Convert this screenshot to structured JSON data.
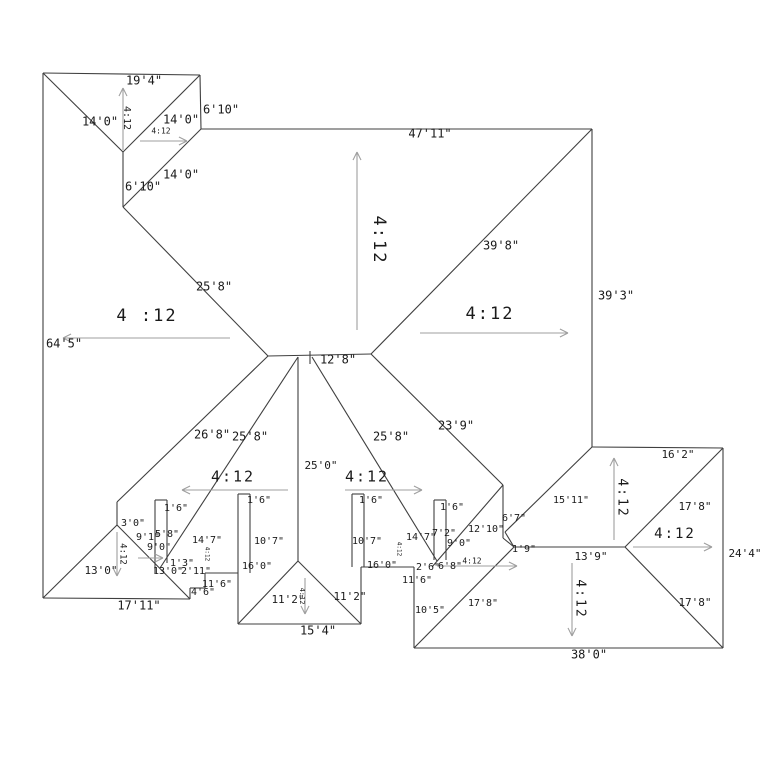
{
  "diagram": {
    "type": "roof-plan",
    "background": "#ffffff",
    "line_color": "#3f3f3f",
    "arrow_color": "#9f9f9f",
    "text_color": "#1a1a1a",
    "default_pitch": "4:12"
  },
  "lines": [
    {
      "x1": 43,
      "y1": 73,
      "x2": 200,
      "y2": 75
    },
    {
      "x1": 200,
      "y1": 75,
      "x2": 201,
      "y2": 129
    },
    {
      "x1": 201,
      "y1": 129,
      "x2": 592,
      "y2": 129
    },
    {
      "x1": 592,
      "y1": 129,
      "x2": 592,
      "y2": 447
    },
    {
      "x1": 592,
      "y1": 447,
      "x2": 723,
      "y2": 448
    },
    {
      "x1": 723,
      "y1": 448,
      "x2": 723,
      "y2": 648
    },
    {
      "x1": 723,
      "y1": 648,
      "x2": 414,
      "y2": 648
    },
    {
      "x1": 414,
      "y1": 648,
      "x2": 414,
      "y2": 567
    },
    {
      "x1": 414,
      "y1": 567,
      "x2": 361,
      "y2": 567
    },
    {
      "x1": 361,
      "y1": 567,
      "x2": 361,
      "y2": 624
    },
    {
      "x1": 361,
      "y1": 624,
      "x2": 238,
      "y2": 624
    },
    {
      "x1": 238,
      "y1": 624,
      "x2": 238,
      "y2": 573
    },
    {
      "x1": 238,
      "y1": 573,
      "x2": 205,
      "y2": 573
    },
    {
      "x1": 205,
      "y1": 573,
      "x2": 205,
      "y2": 588
    },
    {
      "x1": 205,
      "y1": 588,
      "x2": 190,
      "y2": 588
    },
    {
      "x1": 190,
      "y1": 588,
      "x2": 190,
      "y2": 599
    },
    {
      "x1": 190,
      "y1": 599,
      "x2": 43,
      "y2": 598
    },
    {
      "x1": 43,
      "y1": 598,
      "x2": 43,
      "y2": 73
    },
    {
      "x1": 43,
      "y1": 73,
      "x2": 123,
      "y2": 152
    },
    {
      "x1": 200,
      "y1": 75,
      "x2": 123,
      "y2": 152
    },
    {
      "x1": 123,
      "y1": 152,
      "x2": 123,
      "y2": 207
    },
    {
      "x1": 123,
      "y1": 207,
      "x2": 201,
      "y2": 129
    },
    {
      "x1": 123,
      "y1": 207,
      "x2": 268,
      "y2": 356
    },
    {
      "x1": 268,
      "y1": 356,
      "x2": 371,
      "y2": 354
    },
    {
      "x1": 592,
      "y1": 129,
      "x2": 371,
      "y2": 354
    },
    {
      "x1": 310,
      "y1": 351,
      "x2": 310,
      "y2": 364
    },
    {
      "x1": 268,
      "y1": 356,
      "x2": 117,
      "y2": 502
    },
    {
      "x1": 117,
      "y1": 502,
      "x2": 117,
      "y2": 525
    },
    {
      "x1": 117,
      "y1": 525,
      "x2": 43,
      "y2": 598
    },
    {
      "x1": 117,
      "y1": 525,
      "x2": 190,
      "y2": 599
    },
    {
      "x1": 298,
      "y1": 357,
      "x2": 160,
      "y2": 568
    },
    {
      "x1": 298,
      "y1": 357,
      "x2": 298,
      "y2": 561
    },
    {
      "x1": 312,
      "y1": 357,
      "x2": 437,
      "y2": 561
    },
    {
      "x1": 371,
      "y1": 354,
      "x2": 503,
      "y2": 485
    },
    {
      "x1": 298,
      "y1": 561,
      "x2": 238,
      "y2": 624
    },
    {
      "x1": 298,
      "y1": 561,
      "x2": 361,
      "y2": 624
    },
    {
      "x1": 503,
      "y1": 485,
      "x2": 503,
      "y2": 538
    },
    {
      "x1": 503,
      "y1": 538,
      "x2": 514,
      "y2": 547
    },
    {
      "x1": 503,
      "y1": 485,
      "x2": 432,
      "y2": 567
    },
    {
      "x1": 592,
      "y1": 447,
      "x2": 505,
      "y2": 532
    },
    {
      "x1": 505,
      "y1": 532,
      "x2": 514,
      "y2": 547
    },
    {
      "x1": 514,
      "y1": 547,
      "x2": 625,
      "y2": 547
    },
    {
      "x1": 723,
      "y1": 448,
      "x2": 625,
      "y2": 547
    },
    {
      "x1": 723,
      "y1": 648,
      "x2": 625,
      "y2": 547
    },
    {
      "x1": 414,
      "y1": 648,
      "x2": 514,
      "y2": 547
    },
    {
      "x1": 155,
      "y1": 500,
      "x2": 167,
      "y2": 500
    },
    {
      "x1": 155,
      "y1": 500,
      "x2": 155,
      "y2": 573
    },
    {
      "x1": 167,
      "y1": 500,
      "x2": 167,
      "y2": 563
    },
    {
      "x1": 238,
      "y1": 494,
      "x2": 250,
      "y2": 494
    },
    {
      "x1": 238,
      "y1": 494,
      "x2": 238,
      "y2": 573
    },
    {
      "x1": 250,
      "y1": 494,
      "x2": 250,
      "y2": 573
    },
    {
      "x1": 352,
      "y1": 494,
      "x2": 364,
      "y2": 494
    },
    {
      "x1": 352,
      "y1": 494,
      "x2": 352,
      "y2": 567
    },
    {
      "x1": 364,
      "y1": 494,
      "x2": 364,
      "y2": 567
    },
    {
      "x1": 434,
      "y1": 500,
      "x2": 446,
      "y2": 500
    },
    {
      "x1": 434,
      "y1": 500,
      "x2": 434,
      "y2": 560
    },
    {
      "x1": 446,
      "y1": 500,
      "x2": 446,
      "y2": 560
    }
  ],
  "arrows": [
    {
      "x1": 123,
      "y1": 150,
      "x2": 123,
      "y2": 88
    },
    {
      "x1": 140,
      "y1": 141,
      "x2": 187,
      "y2": 141
    },
    {
      "x1": 357,
      "y1": 330,
      "x2": 357,
      "y2": 152
    },
    {
      "x1": 420,
      "y1": 333,
      "x2": 568,
      "y2": 333
    },
    {
      "x1": 230,
      "y1": 338,
      "x2": 63,
      "y2": 338
    },
    {
      "x1": 288,
      "y1": 490,
      "x2": 182,
      "y2": 490
    },
    {
      "x1": 345,
      "y1": 490,
      "x2": 422,
      "y2": 490
    },
    {
      "x1": 138,
      "y1": 558,
      "x2": 163,
      "y2": 558
    },
    {
      "x1": 437,
      "y1": 566,
      "x2": 517,
      "y2": 566
    },
    {
      "x1": 117,
      "y1": 532,
      "x2": 117,
      "y2": 576
    },
    {
      "x1": 305,
      "y1": 578,
      "x2": 305,
      "y2": 614
    },
    {
      "x1": 614,
      "y1": 540,
      "x2": 614,
      "y2": 458
    },
    {
      "x1": 633,
      "y1": 547,
      "x2": 712,
      "y2": 547
    },
    {
      "x1": 572,
      "y1": 563,
      "x2": 572,
      "y2": 636
    }
  ],
  "labels": [
    {
      "t": "19'4\"",
      "x": 144,
      "y": 81,
      "s": 12
    },
    {
      "t": "14'0\"",
      "x": 100,
      "y": 122,
      "s": 12
    },
    {
      "t": "4:12",
      "x": 127,
      "y": 118,
      "s": 10,
      "r": 90
    },
    {
      "t": "14'0\"",
      "x": 181,
      "y": 120,
      "s": 12
    },
    {
      "t": "6'10\"",
      "x": 221,
      "y": 110,
      "s": 12
    },
    {
      "t": "4:12",
      "x": 161,
      "y": 131,
      "s": 8,
      "c": "gray"
    },
    {
      "t": "6'10\"",
      "x": 143,
      "y": 187,
      "s": 12
    },
    {
      "t": "14'0\"",
      "x": 181,
      "y": 175,
      "s": 12
    },
    {
      "t": "47'11\"",
      "x": 430,
      "y": 134,
      "s": 12
    },
    {
      "t": "4:12",
      "x": 379,
      "y": 240,
      "s": 17,
      "r": 90,
      "p": 1
    },
    {
      "t": "39'8\"",
      "x": 501,
      "y": 246,
      "s": 12
    },
    {
      "t": "39'3\"",
      "x": 616,
      "y": 296,
      "s": 12
    },
    {
      "t": "4:12",
      "x": 490,
      "y": 314,
      "s": 17,
      "p": 1
    },
    {
      "t": "4 :12",
      "x": 147,
      "y": 316,
      "s": 17,
      "p": 1
    },
    {
      "t": "64'5\"",
      "x": 64,
      "y": 344,
      "s": 12
    },
    {
      "t": "25'8\"",
      "x": 214,
      "y": 287,
      "s": 12
    },
    {
      "t": "12'8\"",
      "x": 338,
      "y": 360,
      "s": 12
    },
    {
      "t": "26'8\"",
      "x": 212,
      "y": 435,
      "s": 12
    },
    {
      "t": "25'8\"",
      "x": 250,
      "y": 437,
      "s": 12
    },
    {
      "t": "25'8\"",
      "x": 391,
      "y": 437,
      "s": 12
    },
    {
      "t": "23'9\"",
      "x": 456,
      "y": 426,
      "s": 12
    },
    {
      "t": "25'0\"",
      "x": 321,
      "y": 466,
      "s": 11
    },
    {
      "t": "4:12",
      "x": 233,
      "y": 477,
      "s": 15,
      "p": 1
    },
    {
      "t": "4:12",
      "x": 367,
      "y": 477,
      "s": 15,
      "p": 1
    },
    {
      "t": "1'6\"",
      "x": 176,
      "y": 508,
      "s": 10
    },
    {
      "t": "1'6\"",
      "x": 259,
      "y": 500,
      "s": 10
    },
    {
      "t": "1'6\"",
      "x": 371,
      "y": 500,
      "s": 10
    },
    {
      "t": "1'6\"",
      "x": 452,
      "y": 507,
      "s": 10
    },
    {
      "t": "3'0\"",
      "x": 133,
      "y": 523,
      "s": 10
    },
    {
      "t": "9'1\"",
      "x": 148,
      "y": 537,
      "s": 10
    },
    {
      "t": "5'8\"",
      "x": 167,
      "y": 534,
      "s": 10
    },
    {
      "t": "9'0\"",
      "x": 159,
      "y": 547,
      "s": 10
    },
    {
      "t": "14'7\"",
      "x": 207,
      "y": 540,
      "s": 10
    },
    {
      "t": "4:12",
      "x": 207,
      "y": 554,
      "s": 6,
      "r": 90,
      "c": "gray"
    },
    {
      "t": "10'7\"",
      "x": 269,
      "y": 541,
      "s": 10
    },
    {
      "t": "10'7\"",
      "x": 367,
      "y": 541,
      "s": 10
    },
    {
      "t": "1'3\"",
      "x": 182,
      "y": 563,
      "s": 10
    },
    {
      "t": "13'0\"",
      "x": 168,
      "y": 571,
      "s": 10
    },
    {
      "t": "2'11\"",
      "x": 196,
      "y": 571,
      "s": 10
    },
    {
      "t": "16'0\"",
      "x": 257,
      "y": 566,
      "s": 10
    },
    {
      "t": "16'0\"",
      "x": 382,
      "y": 565,
      "s": 10
    },
    {
      "t": "11'6\"",
      "x": 217,
      "y": 584,
      "s": 10
    },
    {
      "t": "4'6\"",
      "x": 203,
      "y": 592,
      "s": 10
    },
    {
      "t": "13'0\"",
      "x": 101,
      "y": 571,
      "s": 11
    },
    {
      "t": "4:12",
      "x": 123,
      "y": 554,
      "s": 9,
      "r": 90,
      "c": "gray"
    },
    {
      "t": "17'11\"",
      "x": 139,
      "y": 606,
      "s": 12
    },
    {
      "t": "11'2\"",
      "x": 288,
      "y": 600,
      "s": 11
    },
    {
      "t": "4:12",
      "x": 302,
      "y": 596,
      "s": 7,
      "r": 90,
      "c": "gray"
    },
    {
      "t": "11'2\"",
      "x": 350,
      "y": 597,
      "s": 11
    },
    {
      "t": "15'4\"",
      "x": 318,
      "y": 631,
      "s": 12
    },
    {
      "t": "14'7\"",
      "x": 421,
      "y": 537,
      "s": 10
    },
    {
      "t": "7'2\"",
      "x": 444,
      "y": 533,
      "s": 10
    },
    {
      "t": "9'0\"",
      "x": 459,
      "y": 543,
      "s": 10
    },
    {
      "t": "4:12",
      "x": 399,
      "y": 549,
      "s": 6,
      "r": 90,
      "c": "gray"
    },
    {
      "t": "2'6\"",
      "x": 428,
      "y": 567,
      "s": 10
    },
    {
      "t": "6'8\"",
      "x": 450,
      "y": 566,
      "s": 10
    },
    {
      "t": "4:12",
      "x": 472,
      "y": 561,
      "s": 8,
      "c": "gray"
    },
    {
      "t": "11'6\"",
      "x": 417,
      "y": 580,
      "s": 10
    },
    {
      "t": "12'10\"",
      "x": 486,
      "y": 529,
      "s": 10
    },
    {
      "t": "6'7\"",
      "x": 514,
      "y": 518,
      "s": 10
    },
    {
      "t": "1'9\"",
      "x": 524,
      "y": 549,
      "s": 10
    },
    {
      "t": "15'11\"",
      "x": 571,
      "y": 500,
      "s": 10
    },
    {
      "t": "16'2\"",
      "x": 678,
      "y": 455,
      "s": 11
    },
    {
      "t": "4:12",
      "x": 622,
      "y": 498,
      "s": 13,
      "r": 90,
      "p": 1
    },
    {
      "t": "17'8\"",
      "x": 695,
      "y": 507,
      "s": 11
    },
    {
      "t": "4:12",
      "x": 675,
      "y": 534,
      "s": 14,
      "p": 1
    },
    {
      "t": "24'4\"",
      "x": 745,
      "y": 554,
      "s": 11
    },
    {
      "t": "13'9\"",
      "x": 591,
      "y": 557,
      "s": 11
    },
    {
      "t": "4:12",
      "x": 580,
      "y": 599,
      "s": 13,
      "r": 90,
      "p": 1
    },
    {
      "t": "17'8\"",
      "x": 695,
      "y": 603,
      "s": 11
    },
    {
      "t": "10'5\"",
      "x": 430,
      "y": 610,
      "s": 10
    },
    {
      "t": "17'8\"",
      "x": 483,
      "y": 603,
      "s": 10
    },
    {
      "t": "38'0\"",
      "x": 589,
      "y": 655,
      "s": 12
    }
  ]
}
